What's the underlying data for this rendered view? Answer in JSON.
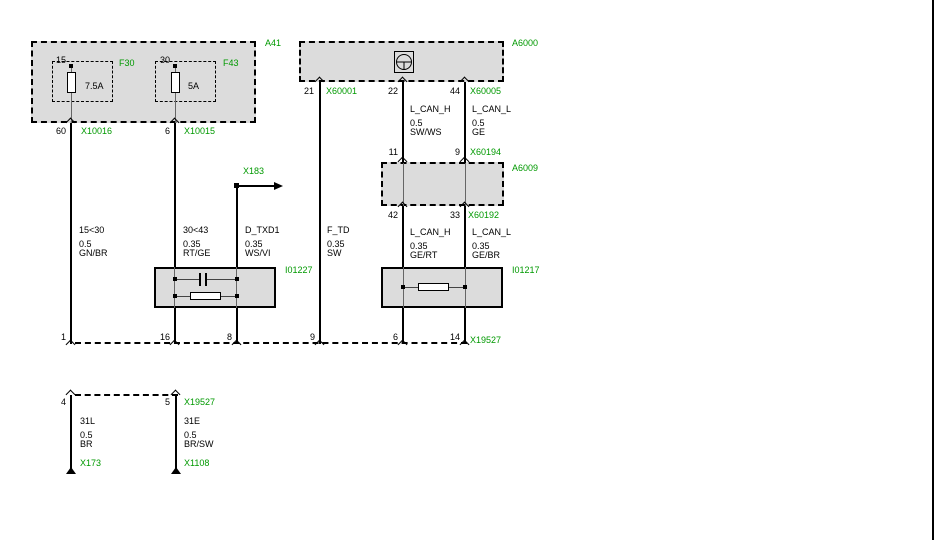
{
  "colors": {
    "label_green": "#009900",
    "box_fill": "#dcdcdc",
    "wire_black": "#000000"
  },
  "boxes": {
    "a41": {
      "label": "A41"
    },
    "f30": {
      "label": "F30",
      "pin": "15",
      "rating": "7.5A"
    },
    "f43": {
      "label": "F43",
      "pin": "30",
      "rating": "5A"
    },
    "a6000": {
      "label": "A6000",
      "icon": "steering-wheel-icon"
    },
    "a6009": {
      "label": "A6009"
    },
    "i01227": {
      "label": "I01227"
    },
    "i01217": {
      "label": "I01217"
    }
  },
  "connectors": {
    "x10016": {
      "label": "X10016",
      "pin": "60"
    },
    "x10015": {
      "label": "X10015",
      "pin": "6"
    },
    "x60001": {
      "label": "X60001",
      "pin": "21"
    },
    "x60005": {
      "label": "X60005",
      "pin_22": "22",
      "pin_44": "44"
    },
    "x60194": {
      "label": "X60194",
      "pin_11": "11",
      "pin_9": "9"
    },
    "x60192": {
      "label": "X60192",
      "pin_42": "42",
      "pin_33": "33"
    },
    "x183": {
      "label": "X183"
    },
    "x19527_main": {
      "label": "X19527",
      "pins": [
        "1",
        "16",
        "8",
        "9",
        "6",
        "14"
      ]
    },
    "x19527_lower": {
      "label": "X19527",
      "pin_4": "4",
      "pin_5": "5"
    },
    "x173": {
      "label": "X173"
    },
    "x1108": {
      "label": "X1108"
    }
  },
  "wires": {
    "kl15": {
      "name": "15<30",
      "gauge": "0.5",
      "color": "GN/BR"
    },
    "kl30": {
      "name": "30<43",
      "gauge": "0.35",
      "color": "RT/GE"
    },
    "d_txd1": {
      "name": "D_TXD1",
      "gauge": "0.35",
      "color": "WS/VI"
    },
    "f_td": {
      "name": "F_TD",
      "gauge": "0.35",
      "color": "SW"
    },
    "lcanh_up": {
      "name": "L_CAN_H",
      "gauge": "0.5",
      "color": "SW/WS"
    },
    "lcanl_up": {
      "name": "L_CAN_L",
      "gauge": "0.5",
      "color": "GE"
    },
    "lcanh_dn": {
      "name": "L_CAN_H",
      "gauge": "0.35",
      "color": "GE/RT"
    },
    "lcanl_dn": {
      "name": "L_CAN_L",
      "gauge": "0.35",
      "color": "GE/BR"
    },
    "kl31l": {
      "name": "31L",
      "gauge": "0.5",
      "color": "BR"
    },
    "kl31e": {
      "name": "31E",
      "gauge": "0.5",
      "color": "BR/SW"
    }
  }
}
